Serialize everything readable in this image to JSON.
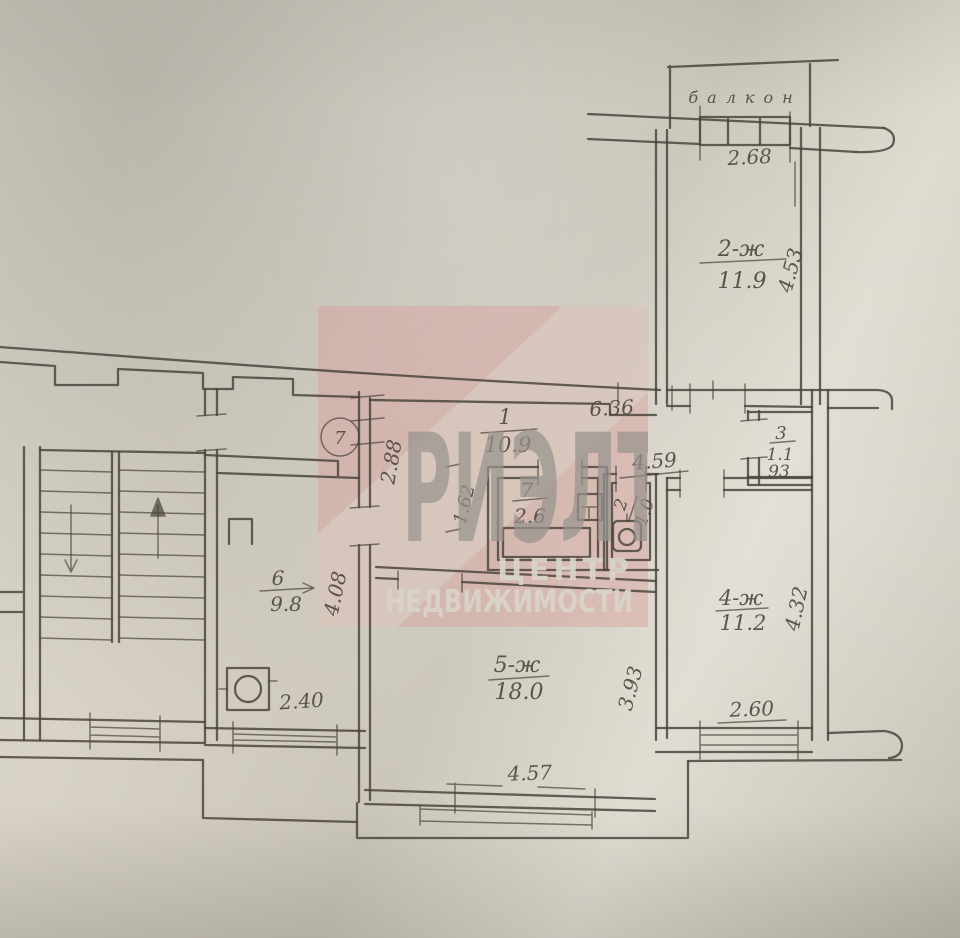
{
  "colors": {
    "paper": "#d8d3c6",
    "ink": "#4a443b",
    "stamp_pink": "#d89a95",
    "stamp_letters": "#98948e",
    "stamp_light_text": "#dad4c8",
    "window_dark": "#6b645e"
  },
  "watermark": {
    "word": "РИЭЛТ",
    "line1": "ЦЕНТР",
    "line2": "НЕДВИЖИМОСТИ"
  },
  "annotation": {
    "circled_number": "7"
  },
  "balcony": {
    "label": "балкон"
  },
  "rooms": {
    "hall": {
      "num": "1",
      "area": "10.9"
    },
    "r2": {
      "num": "2-ж",
      "area": "11.9"
    },
    "r3": {
      "num": "3",
      "area": "1.1"
    },
    "r4": {
      "num": "4-ж",
      "area": "11.2"
    },
    "r5": {
      "num": "5-ж",
      "area": "18.0"
    },
    "r6": {
      "num": "6",
      "area": "9.8"
    },
    "bath": {
      "num": "7",
      "area": "2.6"
    },
    "wc": {
      "num": "2",
      "area": "1.0"
    }
  },
  "dims": {
    "balcony_window": "2.68",
    "room2_depth": "4.53",
    "hall_width": "6.36",
    "corridor": "4.59",
    "hall_depth": "2.88",
    "bath_side": "1.62",
    "closet_width": "93",
    "kitchen_depth": "4.08",
    "kitchen_width": "2.40",
    "room5_depth": "3.93",
    "room4_depth": "4.32",
    "room4_window": "2.60",
    "room5_window": "4.57"
  }
}
